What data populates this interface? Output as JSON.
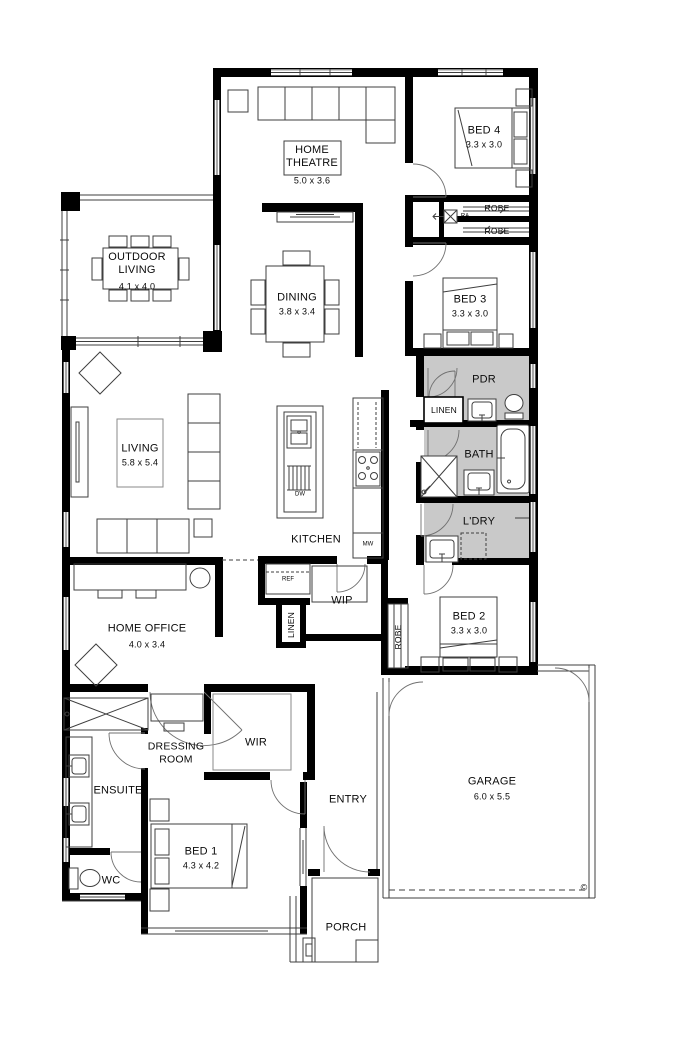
{
  "colors": {
    "wall": "#000000",
    "wet_area_fill": "#c9c9c9",
    "furniture_line": "#3f3f3f",
    "door_arc": "#707070"
  },
  "rooms": {
    "home_theatre": {
      "name": "HOME THEATRE",
      "dims": "5.0 x 3.6"
    },
    "outdoor_living": {
      "name": "OUTDOOR LIVING",
      "dims": "4.1 x 4.0"
    },
    "dining": {
      "name": "DINING",
      "dims": "3.8 x 3.4"
    },
    "living": {
      "name": "LIVING",
      "dims": "5.8 x 5.4"
    },
    "kitchen": {
      "name": "KITCHEN"
    },
    "home_office": {
      "name": "HOME OFFICE",
      "dims": "4.0 x 3.4"
    },
    "bed1": {
      "name": "BED 1",
      "dims": "4.3 x 4.2"
    },
    "bed2": {
      "name": "BED 2",
      "dims": "3.3 x 3.0"
    },
    "bed3": {
      "name": "BED 3",
      "dims": "3.3 x 3.0"
    },
    "bed4": {
      "name": "BED 4",
      "dims": "3.3 x 3.0"
    },
    "garage": {
      "name": "GARAGE",
      "dims": "6.0 x 5.5"
    },
    "bath": {
      "name": "BATH"
    },
    "pdr": {
      "name": "PDR"
    },
    "ldry": {
      "name": "L'DRY"
    },
    "ensuite": {
      "name": "ENSUITE"
    },
    "wc": {
      "name": "WC"
    },
    "wip": {
      "name": "WIP"
    },
    "wir": {
      "name": "WIR"
    },
    "entry": {
      "name": "ENTRY"
    },
    "porch": {
      "name": "PORCH"
    },
    "dressing_room": {
      "name": "DRESSING ROOM"
    }
  },
  "closets": {
    "robe": "ROBE",
    "linen": "LINEN"
  },
  "appliances": {
    "ref": "REF",
    "dw": "DW",
    "mw": "MW",
    "ra": "RA"
  },
  "annotations": {
    "copyright": "©"
  }
}
